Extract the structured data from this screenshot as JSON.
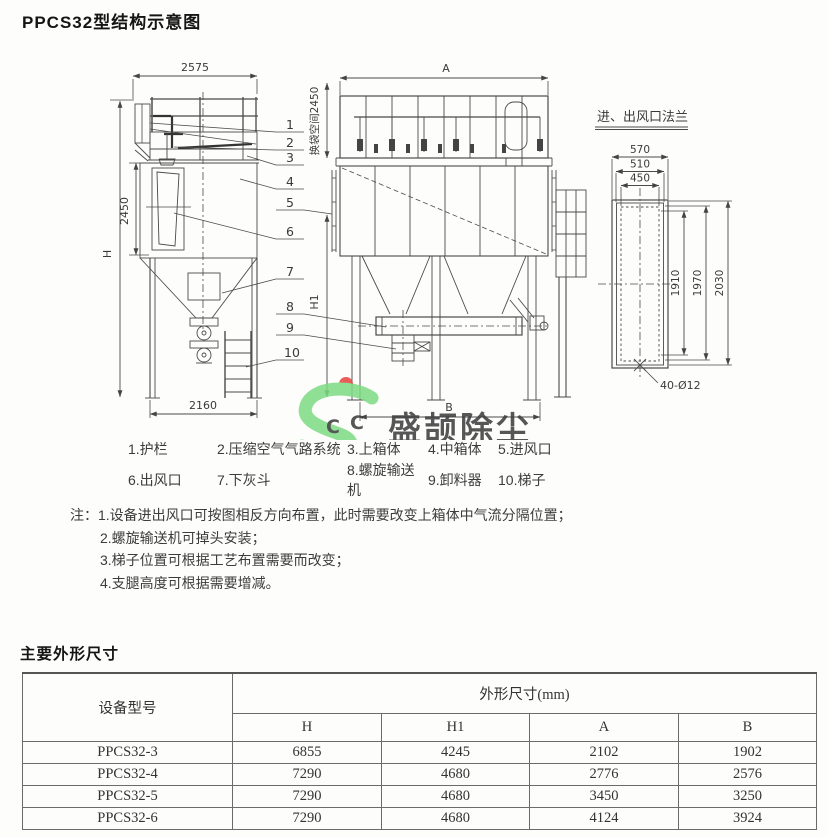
{
  "page": {
    "title": "PPCS32型结构示意图"
  },
  "drawing": {
    "side_view": {
      "dim_top": "2575",
      "dim_bag": "2450",
      "dim_height": "H",
      "dim_base": "2160"
    },
    "front_view": {
      "dim_top": "A",
      "dim_space": "换袋空间2450",
      "dim_h1": "H1",
      "dim_base": "B"
    },
    "flange": {
      "title": "进、出风口法兰",
      "dim_w1": "570",
      "dim_w2": "510",
      "dim_w3": "450",
      "dim_h1": "1910",
      "dim_h2": "1970",
      "dim_h3": "2030",
      "dim_holes": "40-Ø12"
    },
    "leaders": [
      "1",
      "2",
      "3",
      "4",
      "5",
      "6",
      "7",
      "8",
      "9",
      "10"
    ]
  },
  "watermark": {
    "text": "盛颉除尘",
    "letters": [
      "C",
      "C"
    ],
    "colors": {
      "green": "#7cdc82",
      "blue": "#5fa9dc",
      "red": "#e7423d",
      "yellow": "#efe45f"
    }
  },
  "legend": {
    "items": [
      "1.护栏",
      "2.压缩空气气路系统",
      "3.上箱体",
      "4.中箱体",
      "5.进风口",
      "6.出风口",
      "7.下灰斗",
      "8.螺旋输送机",
      "9.卸料器",
      "10.梯子"
    ]
  },
  "notes": {
    "prefix": "注：",
    "lines": [
      "1.设备进出风口可按图相反方向布置，此时需要改变上箱体中气流分隔位置；",
      "2.螺旋输送机可掉头安装；",
      "3.梯子位置可根据工艺布置需要而改变；",
      "4.支腿高度可根据需要增减。"
    ]
  },
  "size_section": {
    "heading": "主要外形尺寸",
    "table": {
      "model_header": "设备型号",
      "group_header": "外形尺寸(mm)",
      "columns": [
        "H",
        "H1",
        "A",
        "B"
      ],
      "rows": [
        {
          "model": "PPCS32-3",
          "h": "6855",
          "h1": "4245",
          "a": "2102",
          "b": "1902"
        },
        {
          "model": "PPCS32-4",
          "h": "7290",
          "h1": "4680",
          "a": "2776",
          "b": "2576"
        },
        {
          "model": "PPCS32-5",
          "h": "7290",
          "h1": "4680",
          "a": "3450",
          "b": "3250"
        },
        {
          "model": "PPCS32-6",
          "h": "7290",
          "h1": "4680",
          "a": "4124",
          "b": "3924"
        }
      ]
    }
  }
}
